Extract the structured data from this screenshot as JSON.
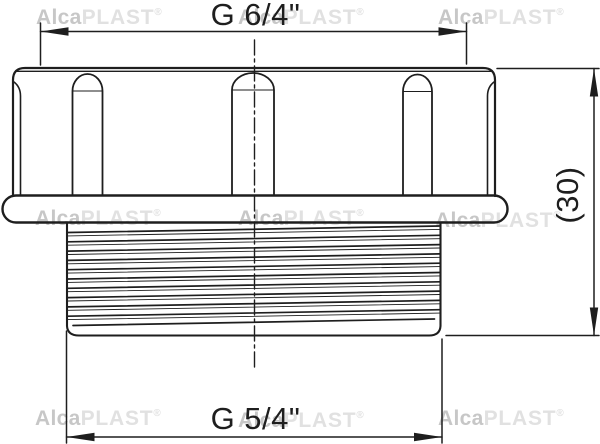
{
  "drawing": {
    "title": "threaded-reducer-fitting",
    "dimensions": {
      "top": "G 6/4\"",
      "bottom": "G 5/4\"",
      "side": "(30)"
    }
  },
  "watermark": {
    "bold": "Alca",
    "light": "PLAST",
    "reg": "®"
  },
  "colors": {
    "line": "#1e1e1e",
    "background": "#ffffff",
    "watermark_bold": "#c7c7c7",
    "watermark_light": "#e1e1e1"
  }
}
